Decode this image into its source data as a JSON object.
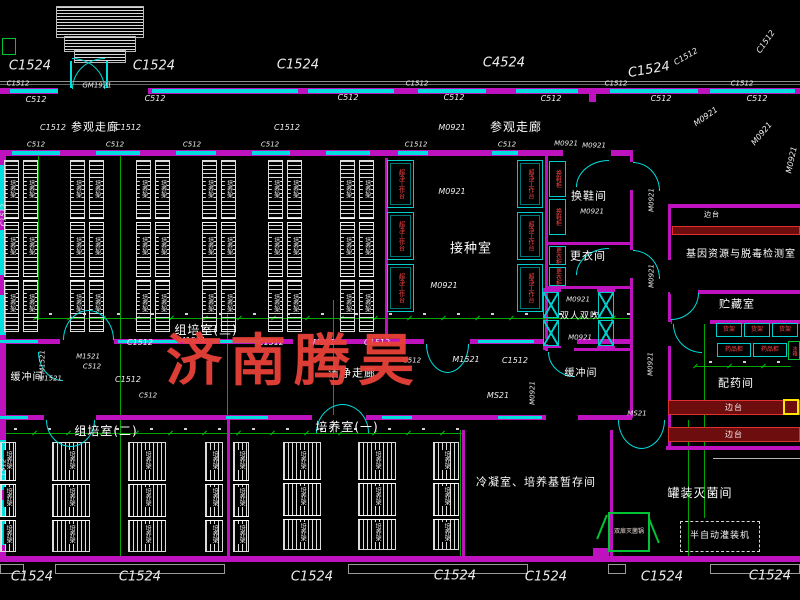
{
  "watermark": {
    "text": "济南腾昊",
    "color": "#e8403a"
  },
  "colors": {
    "background": "#000000",
    "wall": "#bd12bd",
    "window_door": "#00dede",
    "grid": "#00a600",
    "rack": "#dcdcdc",
    "equipment_green": "#00c335",
    "bench_red": "#e03030",
    "label_red": "#ff4545",
    "text": "#f2f2f2",
    "highlight_yellow": "#ffe400",
    "watermark_red": "#e8403a"
  },
  "rack_label": "培养架",
  "labels": [
    {
      "t": "参观走廊",
      "x": 95,
      "y": 127,
      "s": 11,
      "cls": "room",
      "n": "room-label-visiting-corridor-left"
    },
    {
      "t": "参观走廊",
      "x": 516,
      "y": 127,
      "s": 12,
      "cls": "room",
      "n": "room-label-visiting-corridor-right"
    },
    {
      "t": "组培室(三)",
      "x": 206,
      "y": 330,
      "s": 12,
      "cls": "room",
      "n": "room-label-tissue-culture-room-3"
    },
    {
      "t": "接种室",
      "x": 471,
      "y": 249,
      "s": 13,
      "cls": "room",
      "n": "room-label-inoculation-room"
    },
    {
      "t": "换鞋间",
      "x": 589,
      "y": 196,
      "s": 11,
      "cls": "room",
      "n": "room-label-shoe-change-room"
    },
    {
      "t": "更衣间",
      "x": 588,
      "y": 256,
      "s": 11,
      "cls": "room",
      "n": "room-label-changing-room"
    },
    {
      "t": "双人双吹",
      "x": 580,
      "y": 317,
      "s": 9,
      "cls": "room",
      "n": "room-label-air-shower"
    },
    {
      "t": "缓冲间",
      "x": 27,
      "y": 378,
      "s": 10,
      "cls": "room",
      "n": "room-label-buffer-room-left"
    },
    {
      "t": "缓冲间",
      "x": 581,
      "y": 374,
      "s": 10,
      "cls": "room",
      "n": "room-label-buffer-room-right"
    },
    {
      "t": "洁净走廊",
      "x": 352,
      "y": 373,
      "s": 11,
      "cls": "room",
      "n": "room-label-clean-corridor"
    },
    {
      "t": "组培室(二)",
      "x": 106,
      "y": 431,
      "s": 12,
      "cls": "room",
      "n": "room-label-tissue-culture-room-2"
    },
    {
      "t": "培养室(一)",
      "x": 347,
      "y": 427,
      "s": 12,
      "cls": "room",
      "n": "room-label-culture-room-1"
    },
    {
      "t": "冷凝室、培养基暂存间",
      "x": 536,
      "y": 482,
      "s": 11,
      "cls": "room",
      "n": "room-label-condensation-media-storage"
    },
    {
      "t": "罐装灭菌间",
      "x": 700,
      "y": 493,
      "s": 12,
      "cls": "room",
      "n": "room-label-canning-sterilization-room"
    },
    {
      "t": "基因资源与脱毒检测室",
      "x": 741,
      "y": 255,
      "s": 10,
      "cls": "room",
      "n": "room-label-gene-resource-detection-room"
    },
    {
      "t": "贮藏室",
      "x": 737,
      "y": 304,
      "s": 11,
      "cls": "room",
      "n": "room-label-storage-room"
    },
    {
      "t": "配药间",
      "x": 736,
      "y": 383,
      "s": 11,
      "cls": "room",
      "n": "room-label-drug-preparation-room"
    },
    {
      "t": "边台",
      "x": 712,
      "y": 215,
      "s": 7,
      "cls": "room",
      "n": "equipment-label-side-bench"
    },
    {
      "t": "C1524",
      "x": 30,
      "y": 66,
      "s": 13,
      "cls": "code",
      "n": "window-code"
    },
    {
      "t": "C1524",
      "x": 154,
      "y": 66,
      "s": 13,
      "cls": "code",
      "n": "window-code"
    },
    {
      "t": "C1524",
      "x": 298,
      "y": 65,
      "s": 13,
      "cls": "code",
      "n": "window-code"
    },
    {
      "t": "C4524",
      "x": 504,
      "y": 63,
      "s": 13,
      "cls": "code",
      "n": "window-code"
    },
    {
      "t": "C1524",
      "x": 649,
      "y": 70,
      "s": 13,
      "r": -10,
      "cls": "code",
      "n": "window-code"
    },
    {
      "t": "C1512",
      "x": 686,
      "y": 57,
      "s": 8,
      "r": -30,
      "cls": "code",
      "n": "window-code"
    },
    {
      "t": "C1512",
      "x": 766,
      "y": 42,
      "s": 8,
      "r": -55,
      "cls": "code",
      "n": "window-code"
    },
    {
      "t": "C1512",
      "x": 18,
      "y": 84,
      "s": 7,
      "cls": "code",
      "n": "window-code"
    },
    {
      "t": "GM1921",
      "x": 97,
      "y": 86,
      "s": 7,
      "cls": "code",
      "n": "door-code"
    },
    {
      "t": "C1512",
      "x": 417,
      "y": 84,
      "s": 7,
      "cls": "code",
      "n": "window-code"
    },
    {
      "t": "C1512",
      "x": 616,
      "y": 84,
      "s": 7,
      "cls": "code",
      "n": "window-code"
    },
    {
      "t": "C1512",
      "x": 742,
      "y": 84,
      "s": 7,
      "cls": "code",
      "n": "window-code"
    },
    {
      "t": "C512",
      "x": 36,
      "y": 100,
      "s": 8,
      "cls": "code",
      "n": "window-code"
    },
    {
      "t": "C512",
      "x": 155,
      "y": 99,
      "s": 8,
      "cls": "code",
      "n": "window-code"
    },
    {
      "t": "C512",
      "x": 348,
      "y": 98,
      "s": 8,
      "cls": "code",
      "n": "window-code"
    },
    {
      "t": "C512",
      "x": 454,
      "y": 98,
      "s": 8,
      "cls": "code",
      "n": "window-code"
    },
    {
      "t": "C512",
      "x": 551,
      "y": 99,
      "s": 8,
      "cls": "code",
      "n": "window-code"
    },
    {
      "t": "C512",
      "x": 661,
      "y": 99,
      "s": 8,
      "cls": "code",
      "n": "window-code"
    },
    {
      "t": "C512",
      "x": 757,
      "y": 99,
      "s": 8,
      "cls": "code",
      "n": "window-code"
    },
    {
      "t": "C1512",
      "x": 53,
      "y": 128,
      "s": 8,
      "cls": "code",
      "n": "window-code"
    },
    {
      "t": "C1512",
      "x": 128,
      "y": 128,
      "s": 8,
      "cls": "code",
      "n": "window-code"
    },
    {
      "t": "C1512",
      "x": 287,
      "y": 128,
      "s": 8,
      "cls": "code",
      "n": "window-code"
    },
    {
      "t": "M0921",
      "x": 452,
      "y": 128,
      "s": 8,
      "cls": "code",
      "n": "door-code"
    },
    {
      "t": "M0921",
      "x": 594,
      "y": 146,
      "s": 7,
      "cls": "code",
      "n": "door-code"
    },
    {
      "t": "C512",
      "x": 36,
      "y": 145,
      "s": 7,
      "cls": "code",
      "n": "window-code"
    },
    {
      "t": "C512",
      "x": 115,
      "y": 145,
      "s": 7,
      "cls": "code",
      "n": "window-code"
    },
    {
      "t": "C512",
      "x": 192,
      "y": 145,
      "s": 7,
      "cls": "code",
      "n": "window-code"
    },
    {
      "t": "C512",
      "x": 270,
      "y": 145,
      "s": 7,
      "cls": "code",
      "n": "window-code"
    },
    {
      "t": "C1512",
      "x": 416,
      "y": 145,
      "s": 7,
      "cls": "code",
      "n": "window-code"
    },
    {
      "t": "C512",
      "x": 507,
      "y": 145,
      "s": 7,
      "cls": "code",
      "n": "window-code"
    },
    {
      "t": "M0921",
      "x": 566,
      "y": 144,
      "s": 7,
      "cls": "code",
      "n": "door-code"
    },
    {
      "t": "M0921",
      "x": 452,
      "y": 192,
      "s": 8,
      "cls": "code",
      "n": "door-code"
    },
    {
      "t": "M0921",
      "x": 444,
      "y": 286,
      "s": 8,
      "cls": "code",
      "n": "door-code"
    },
    {
      "t": "M0921",
      "x": 706,
      "y": 117,
      "s": 8,
      "r": -35,
      "cls": "code",
      "n": "door-code"
    },
    {
      "t": "M0921",
      "x": 762,
      "y": 134,
      "s": 8,
      "r": -50,
      "cls": "code",
      "n": "door-code"
    },
    {
      "t": "M0921",
      "x": 792,
      "y": 160,
      "s": 8,
      "r": -78,
      "cls": "code",
      "n": "door-code"
    },
    {
      "t": "M0921",
      "x": 652,
      "y": 200,
      "s": 7,
      "r": -90,
      "cls": "code",
      "n": "door-code"
    },
    {
      "t": "M0921",
      "x": 652,
      "y": 276,
      "s": 7,
      "r": -90,
      "cls": "code",
      "n": "door-code"
    },
    {
      "t": "M0921",
      "x": 651,
      "y": 364,
      "s": 7,
      "r": -90,
      "cls": "code",
      "n": "door-code"
    },
    {
      "t": "MS21",
      "x": 637,
      "y": 414,
      "s": 7,
      "cls": "code",
      "n": "door-code"
    },
    {
      "t": "M0921",
      "x": 592,
      "y": 212,
      "s": 7,
      "cls": "code",
      "n": "door-code"
    },
    {
      "t": "M0921",
      "x": 578,
      "y": 300,
      "s": 7,
      "cls": "code",
      "n": "door-code"
    },
    {
      "t": "M0921",
      "x": 580,
      "y": 338,
      "s": 7,
      "cls": "code",
      "n": "door-code"
    },
    {
      "t": "C1512",
      "x": 140,
      "y": 343,
      "s": 8,
      "cls": "code",
      "n": "window-code"
    },
    {
      "t": "M1521",
      "x": 192,
      "y": 341,
      "s": 8,
      "cls": "code",
      "n": "door-code"
    },
    {
      "t": "C1512",
      "x": 271,
      "y": 343,
      "s": 8,
      "cls": "code",
      "n": "window-code"
    },
    {
      "t": "MS21",
      "x": 324,
      "y": 343,
      "s": 8,
      "cls": "code",
      "n": "door-code"
    },
    {
      "t": "C1512",
      "x": 377,
      "y": 343,
      "s": 8,
      "cls": "code",
      "n": "window-code"
    },
    {
      "t": "C512",
      "x": 412,
      "y": 361,
      "s": 7,
      "cls": "code",
      "n": "window-code"
    },
    {
      "t": "M1521",
      "x": 466,
      "y": 360,
      "s": 8,
      "cls": "code",
      "n": "door-code"
    },
    {
      "t": "C1512",
      "x": 515,
      "y": 361,
      "s": 8,
      "cls": "code",
      "n": "window-code"
    },
    {
      "t": "MS21",
      "x": 498,
      "y": 396,
      "s": 8,
      "cls": "code",
      "n": "door-code"
    },
    {
      "t": "M0921",
      "x": 533,
      "y": 393,
      "s": 7,
      "r": -90,
      "cls": "code",
      "n": "door-code"
    },
    {
      "t": "C512",
      "x": 92,
      "y": 367,
      "s": 7,
      "cls": "code",
      "n": "window-code"
    },
    {
      "t": "C1512",
      "x": 128,
      "y": 380,
      "s": 8,
      "cls": "code",
      "n": "window-code"
    },
    {
      "t": "C512",
      "x": 148,
      "y": 396,
      "s": 7,
      "cls": "code",
      "n": "window-code"
    },
    {
      "t": "M1521",
      "x": 50,
      "y": 379,
      "s": 7,
      "cls": "code",
      "n": "door-code"
    },
    {
      "t": "M1521",
      "x": 43,
      "y": 362,
      "s": 7,
      "r": -90,
      "cls": "code",
      "n": "door-code"
    },
    {
      "t": "M1521",
      "x": 88,
      "y": 357,
      "s": 7,
      "cls": "code",
      "n": "door-code"
    },
    {
      "t": "C1524",
      "x": 32,
      "y": 577,
      "s": 13,
      "cls": "code",
      "n": "window-code"
    },
    {
      "t": "C1524",
      "x": 140,
      "y": 577,
      "s": 13,
      "cls": "code",
      "n": "window-code"
    },
    {
      "t": "C1524",
      "x": 312,
      "y": 577,
      "s": 13,
      "cls": "code",
      "n": "window-code"
    },
    {
      "t": "C1524",
      "x": 455,
      "y": 576,
      "s": 13,
      "cls": "code",
      "n": "window-code"
    },
    {
      "t": "C1524",
      "x": 546,
      "y": 577,
      "s": 13,
      "cls": "code",
      "n": "window-code"
    },
    {
      "t": "C1524",
      "x": 662,
      "y": 577,
      "s": 13,
      "cls": "code",
      "n": "window-code"
    },
    {
      "t": "C1524",
      "x": 770,
      "y": 576,
      "s": 13,
      "cls": "code",
      "n": "window-code"
    },
    {
      "t": "C1512",
      "x": 4,
      "y": 215,
      "s": 7,
      "r": -90,
      "cls": "code",
      "n": "window-code"
    },
    {
      "t": "C1512",
      "x": 4,
      "y": 470,
      "s": 7,
      "r": -90,
      "cls": "code",
      "n": "window-code"
    }
  ],
  "racks": [
    {
      "x": 4,
      "y": 160,
      "w": 15,
      "h": 172,
      "dir": "h"
    },
    {
      "x": 23,
      "y": 160,
      "w": 15,
      "h": 172,
      "dir": "h"
    },
    {
      "x": 70,
      "y": 160,
      "w": 15,
      "h": 172,
      "dir": "h"
    },
    {
      "x": 89,
      "y": 160,
      "w": 15,
      "h": 172,
      "dir": "h"
    },
    {
      "x": 136,
      "y": 160,
      "w": 15,
      "h": 172,
      "dir": "h"
    },
    {
      "x": 155,
      "y": 160,
      "w": 15,
      "h": 172,
      "dir": "h"
    },
    {
      "x": 202,
      "y": 160,
      "w": 15,
      "h": 172,
      "dir": "h"
    },
    {
      "x": 221,
      "y": 160,
      "w": 15,
      "h": 172,
      "dir": "h"
    },
    {
      "x": 268,
      "y": 160,
      "w": 15,
      "h": 172,
      "dir": "h"
    },
    {
      "x": 287,
      "y": 160,
      "w": 15,
      "h": 172,
      "dir": "h"
    },
    {
      "x": 340,
      "y": 160,
      "w": 15,
      "h": 172,
      "dir": "h"
    },
    {
      "x": 359,
      "y": 160,
      "w": 15,
      "h": 172,
      "dir": "h"
    },
    {
      "x": 0,
      "y": 442,
      "w": 16,
      "h": 110,
      "dir": "v"
    },
    {
      "x": 52,
      "y": 442,
      "w": 38,
      "h": 110,
      "dir": "v"
    },
    {
      "x": 128,
      "y": 442,
      "w": 38,
      "h": 110,
      "dir": "v"
    },
    {
      "x": 205,
      "y": 442,
      "w": 18,
      "h": 110,
      "dir": "v"
    },
    {
      "x": 233,
      "y": 442,
      "w": 16,
      "h": 110,
      "dir": "v"
    },
    {
      "x": 283,
      "y": 442,
      "w": 38,
      "h": 108,
      "dir": "v"
    },
    {
      "x": 358,
      "y": 442,
      "w": 38,
      "h": 108,
      "dir": "v"
    },
    {
      "x": 433,
      "y": 442,
      "w": 26,
      "h": 108,
      "dir": "v"
    }
  ],
  "equipment": [
    {
      "x": 387,
      "y": 160,
      "w": 27,
      "h": 48,
      "kind": "clean",
      "label": "超净工作台",
      "n": "clean-bench"
    },
    {
      "x": 387,
      "y": 212,
      "w": 27,
      "h": 48,
      "kind": "clean",
      "label": "超净工作台",
      "n": "clean-bench"
    },
    {
      "x": 387,
      "y": 264,
      "w": 27,
      "h": 48,
      "kind": "clean",
      "label": "超净工作台",
      "n": "clean-bench"
    },
    {
      "x": 517,
      "y": 160,
      "w": 26,
      "h": 48,
      "kind": "clean",
      "label": "超净工作台",
      "n": "clean-bench"
    },
    {
      "x": 517,
      "y": 212,
      "w": 26,
      "h": 48,
      "kind": "clean",
      "label": "超净工作台",
      "n": "clean-bench"
    },
    {
      "x": 517,
      "y": 264,
      "w": 26,
      "h": 48,
      "kind": "clean",
      "label": "超净工作台",
      "n": "clean-bench"
    },
    {
      "x": 549,
      "y": 161,
      "w": 17,
      "h": 36,
      "kind": "cabv",
      "label": "换鞋柜",
      "n": "shoe-cabinet"
    },
    {
      "x": 549,
      "y": 199,
      "w": 17,
      "h": 36,
      "kind": "cabv",
      "label": "换鞋柜",
      "n": "shoe-cabinet"
    },
    {
      "x": 549,
      "y": 246,
      "w": 17,
      "h": 19,
      "kind": "cabv",
      "label": "更衣柜",
      "n": "wardrobe-cabinet"
    },
    {
      "x": 549,
      "y": 267,
      "w": 17,
      "h": 19,
      "kind": "cabv",
      "label": "更衣柜",
      "n": "wardrobe-cabinet"
    },
    {
      "x": 543,
      "y": 292,
      "w": 16,
      "h": 26,
      "kind": "xbox",
      "label": "",
      "n": "air-shower-unit"
    },
    {
      "x": 543,
      "y": 320,
      "w": 16,
      "h": 26,
      "kind": "xbox",
      "label": "",
      "n": "air-shower-unit"
    },
    {
      "x": 598,
      "y": 292,
      "w": 16,
      "h": 26,
      "kind": "xbox",
      "label": "",
      "n": "air-shower-unit"
    },
    {
      "x": 598,
      "y": 320,
      "w": 16,
      "h": 26,
      "kind": "xbox",
      "label": "",
      "n": "air-shower-unit"
    },
    {
      "x": 672,
      "y": 226,
      "w": 128,
      "h": 9,
      "kind": "bench",
      "label": "",
      "n": "side-bench"
    },
    {
      "x": 716,
      "y": 323,
      "w": 26,
      "h": 14,
      "kind": "cab",
      "label": "货架",
      "n": "shelf-unit"
    },
    {
      "x": 744,
      "y": 323,
      "w": 26,
      "h": 14,
      "kind": "cab",
      "label": "货架",
      "n": "shelf-unit"
    },
    {
      "x": 772,
      "y": 323,
      "w": 26,
      "h": 14,
      "kind": "cab",
      "label": "货架",
      "n": "shelf-unit"
    },
    {
      "x": 717,
      "y": 343,
      "w": 34,
      "h": 14,
      "kind": "cab",
      "label": "药品柜",
      "n": "medicine-cabinet"
    },
    {
      "x": 753,
      "y": 343,
      "w": 34,
      "h": 14,
      "kind": "cab",
      "label": "药品柜",
      "n": "medicine-cabinet"
    },
    {
      "x": 788,
      "y": 341,
      "w": 12,
      "h": 19,
      "kind": "greenv",
      "label": "冰箱",
      "n": "fridge"
    },
    {
      "x": 668,
      "y": 400,
      "w": 132,
      "h": 15,
      "kind": "bench",
      "label": "边台",
      "n": "side-bench"
    },
    {
      "x": 668,
      "y": 427,
      "w": 132,
      "h": 15,
      "kind": "bench",
      "label": "边台",
      "n": "side-bench"
    },
    {
      "x": 783,
      "y": 399,
      "w": 16,
      "h": 16,
      "kind": "yellow",
      "label": "",
      "n": "balance"
    },
    {
      "x": 608,
      "y": 512,
      "w": 42,
      "h": 40,
      "kind": "sterile",
      "label": "双扉灭菌锅",
      "n": "double-door-sterilizer"
    },
    {
      "x": 680,
      "y": 521,
      "w": 80,
      "h": 31,
      "kind": "filler",
      "label": "半自动灌装机",
      "n": "filling-machine"
    }
  ]
}
